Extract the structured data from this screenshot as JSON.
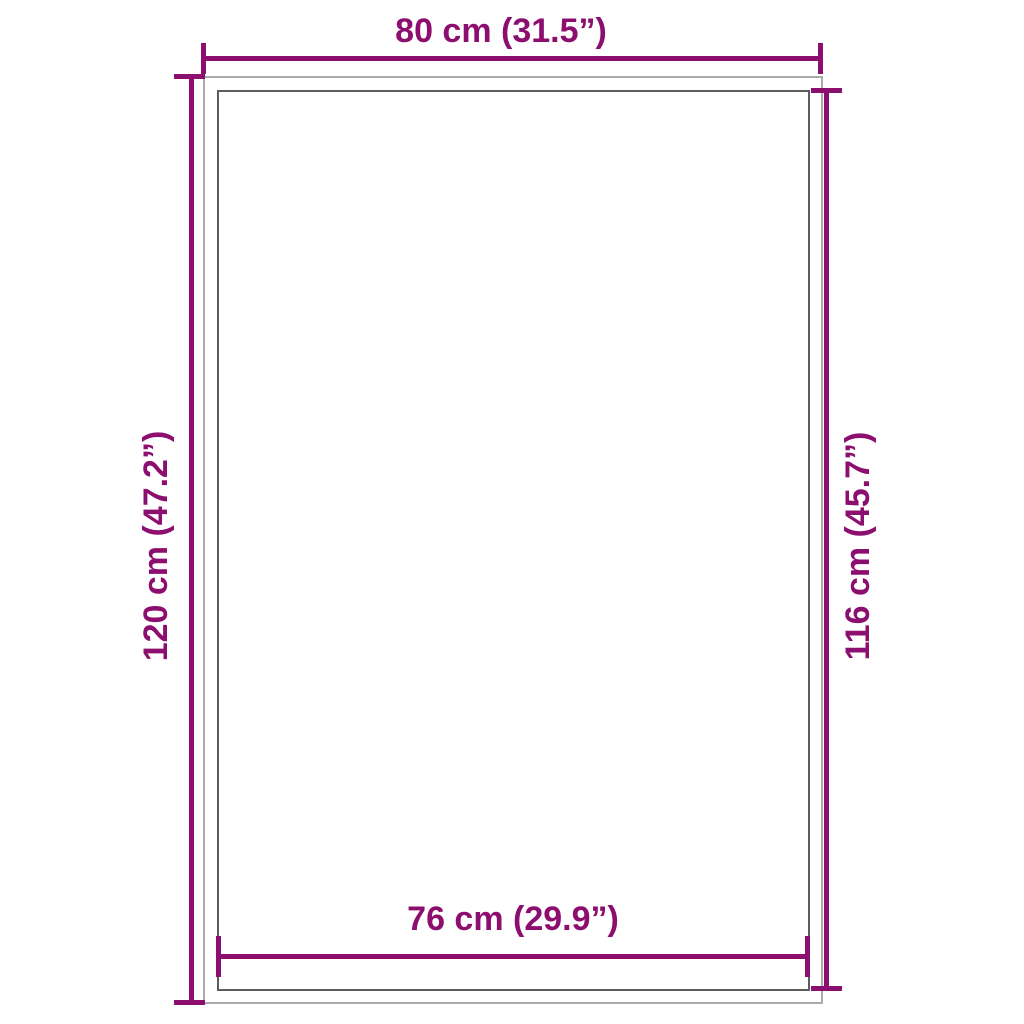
{
  "diagram": {
    "type": "product-dimension-diagram",
    "shape": "rectangle-with-inner-border",
    "dimensions": {
      "top": {
        "label": "80 cm (31.5”)",
        "measures": "outer-width"
      },
      "bottom": {
        "label": "76 cm (29.9”)",
        "measures": "inner-width"
      },
      "left": {
        "label": "120 cm (47.2”)",
        "measures": "outer-height"
      },
      "right": {
        "label": "116 cm (45.7”)",
        "measures": "inner-height"
      }
    }
  },
  "colors": {
    "accent": "#8c0e6f",
    "outer-border": "#ababab",
    "inner-border": "#5c5c5c",
    "background": "#ffffff"
  }
}
